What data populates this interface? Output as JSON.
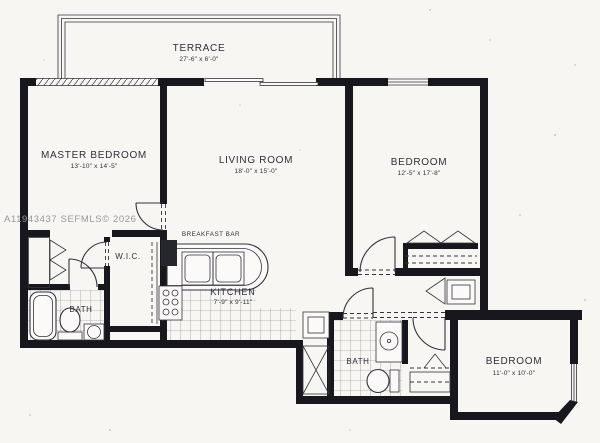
{
  "watermark": "A11943437  SEFMLS© 2026",
  "colors": {
    "paper": "#f7f6f3",
    "ink": "#33333d",
    "wall": "#17171d",
    "watermark": "#97979f"
  },
  "rooms": {
    "terrace": {
      "name": "TERRACE",
      "dims": "27'-6\" x 6'-0\""
    },
    "master_bedroom": {
      "name": "MASTER BEDROOM",
      "dims": "13'-10\" x 14'-5\""
    },
    "living_room": {
      "name": "LIVING ROOM",
      "dims": "18'-0\" x 15'-0\""
    },
    "bedroom_right": {
      "name": "BEDROOM",
      "dims": "12'-5\" x 17'-8\""
    },
    "bedroom_bottom": {
      "name": "BEDROOM",
      "dims": "11'-0\" x 10'-0\""
    },
    "kitchen": {
      "name": "KITCHEN",
      "dims": "7'-9\" x 9'-11\""
    },
    "breakfast_bar": {
      "name": "BREAKFAST BAR"
    },
    "wic": {
      "name": "W.I.C."
    },
    "bath_master": {
      "name": "BATH"
    },
    "bath_second": {
      "name": "BATH"
    }
  }
}
